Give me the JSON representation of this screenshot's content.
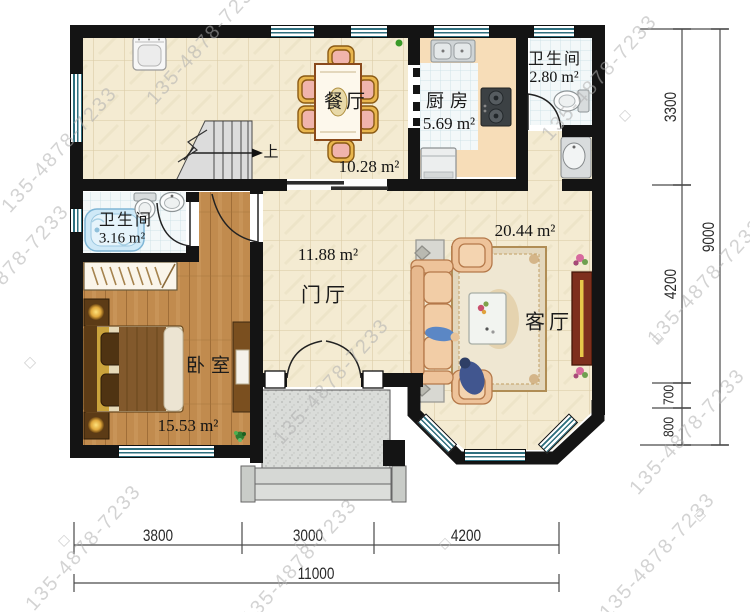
{
  "plan": {
    "rooms": [
      {
        "id": "dining",
        "name": "餐厅",
        "area": "10.28 m²"
      },
      {
        "id": "kitchen",
        "name": "厨房",
        "area": "5.69 m²"
      },
      {
        "id": "bath-top",
        "name": "卫生间",
        "area": "2.80 m²"
      },
      {
        "id": "bath-left",
        "name": "卫生间",
        "area": "3.16 m²"
      },
      {
        "id": "bedroom",
        "name": "卧室",
        "area": "15.53 m²"
      },
      {
        "id": "hall",
        "name": "门厅",
        "area": "11.88 m²"
      },
      {
        "id": "living",
        "name": "客厅",
        "area": "20.44 m²"
      }
    ],
    "stairs_label": "上",
    "dimensions": {
      "bottom": {
        "segments": [
          "3800",
          "3000",
          "4200"
        ],
        "total": "11000"
      },
      "right": {
        "segments": [
          "3300",
          "4200",
          "700",
          "800"
        ],
        "total": "9000"
      }
    },
    "watermark": "135-4878-7233",
    "watermark_diamond": "◇",
    "colors": {
      "wall": "#141414",
      "floor_tile": "#f4ebd2",
      "bath_tile": "#f3f8f9",
      "wood_floor": "#c18b4e",
      "window_glass": "#2e6f7e",
      "kitchen_counter": "#f7ddb8",
      "sofa": "#f0c8a0",
      "tv_cabinet": "#7e2f1d",
      "bathtub": "#cfe9f7"
    }
  }
}
